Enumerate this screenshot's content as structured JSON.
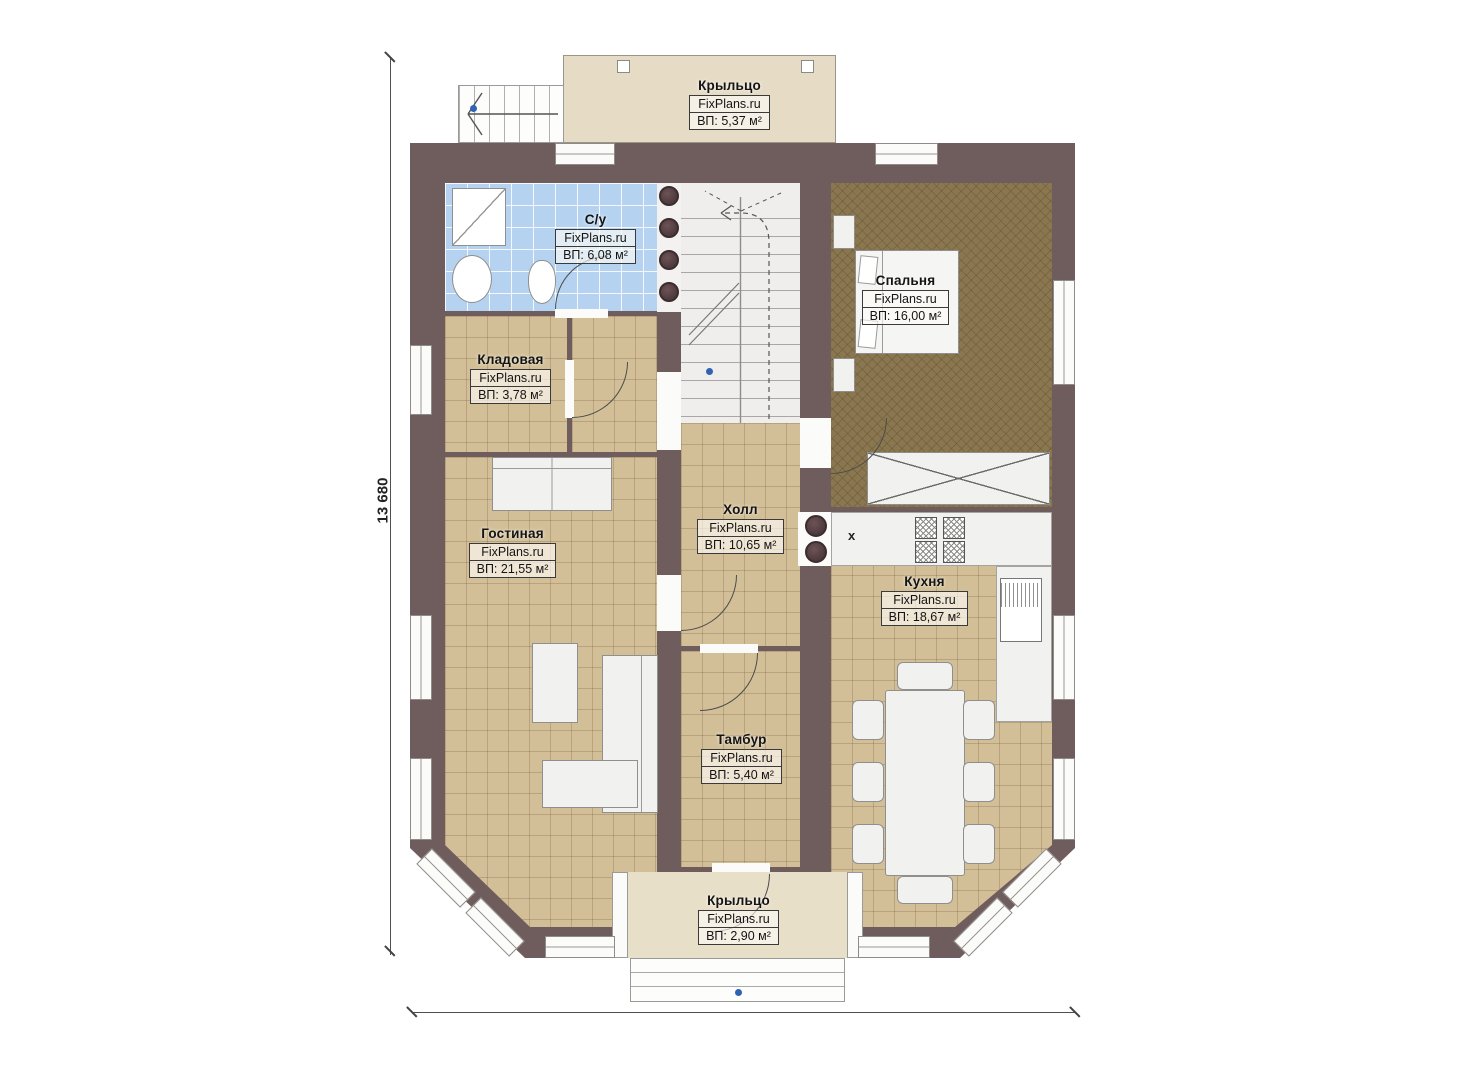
{
  "plan": {
    "brand": "FixPlans.ru",
    "dims": {
      "height_label": "13 680",
      "width_label": "10 180"
    },
    "markers": {
      "sink_x": "x"
    },
    "colors": {
      "wall": "#6f5d5d",
      "floor_tile": "#d3bf97",
      "bathroom_tile": "#b5d3f0",
      "bedroom_floor": "#8a7750",
      "porch": "#e6dcc6",
      "marker_blue": "#2f62b5"
    },
    "rooms": {
      "porch_top": {
        "name": "Крыльцо",
        "brand": "FixPlans.ru",
        "area": "ВП: 5,37 м²"
      },
      "bathroom": {
        "name": "С/у",
        "brand": "FixPlans.ru",
        "area": "ВП: 6,08 м²"
      },
      "bedroom": {
        "name": "Спальня",
        "brand": "FixPlans.ru",
        "area": "ВП: 16,00 м²"
      },
      "storage": {
        "name": "Кладовая",
        "brand": "FixPlans.ru",
        "area": "ВП: 3,78 м²"
      },
      "living": {
        "name": "Гостиная",
        "brand": "FixPlans.ru",
        "area": "ВП: 21,55 м²"
      },
      "hall": {
        "name": "Холл",
        "brand": "FixPlans.ru",
        "area": "ВП: 10,65 м²"
      },
      "kitchen": {
        "name": "Кухня",
        "brand": "FixPlans.ru",
        "area": "ВП: 18,67 м²"
      },
      "vestibule": {
        "name": "Тамбур",
        "brand": "FixPlans.ru",
        "area": "ВП: 5,40 м²"
      },
      "porch_bottom": {
        "name": "Крыльцо",
        "brand": "FixPlans.ru",
        "area": "ВП: 2,90 м²"
      }
    }
  }
}
